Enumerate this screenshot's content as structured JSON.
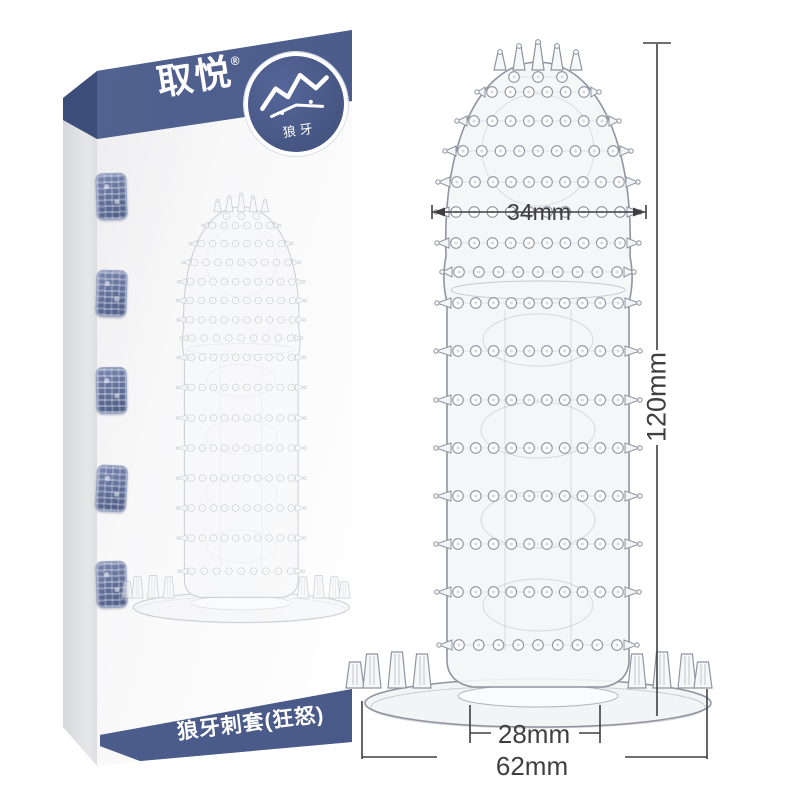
{
  "page": {
    "background": "#ffffff",
    "kind": "product photo with size diagram"
  },
  "box": {
    "brand": "取悦",
    "trademark": "®",
    "badge": {
      "icon": "wolf-icon",
      "label": "狼牙"
    },
    "series_label": "狼牙刺套(狂怒)",
    "seal_stamp_count": 5
  },
  "dimensions": {
    "tip_width": "34mm",
    "total_length": "120mm",
    "inner_width": "28mm",
    "base_width": "62mm"
  },
  "colors": {
    "band_blue": "#4a5b8c",
    "band_blue_dark": "#3d4d79",
    "dimension_ink": "#3f3f41",
    "product_line_gray": "#8f949e"
  }
}
